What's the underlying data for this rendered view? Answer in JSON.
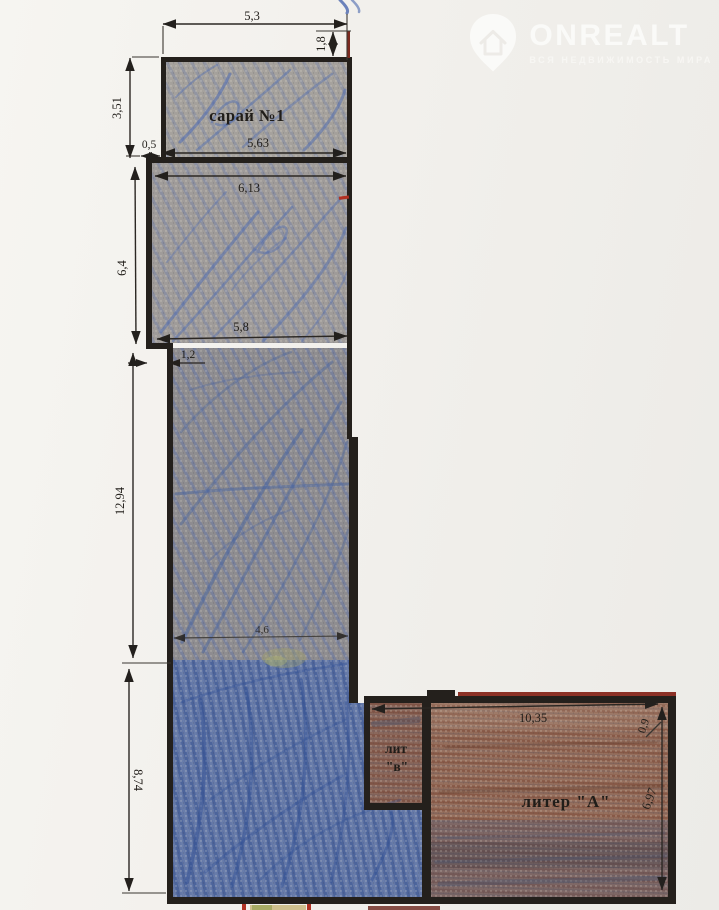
{
  "watermark": {
    "brand": "ONREALT",
    "tagline": "ВСЯ НЕДВИЖИМОСТЬ МИРА"
  },
  "plan": {
    "rooms": {
      "shed_label": "сарай №1",
      "lit_v_line1": "лит",
      "lit_v_line2": "\"в\"",
      "liter_a_label": "литер \"А\""
    },
    "dimensions": {
      "top_width": "5,3",
      "shed_side": "1,8",
      "shed_height": "3,51",
      "left_offset": "0,5",
      "shed_width": "5,63",
      "section2_width": "6,13",
      "section2_height": "6,4",
      "section3_width": "5,8",
      "step": "1,2",
      "section3_height": "12,94",
      "section4_width": "4,6",
      "section4_height": "8,74",
      "liter_a_width": "10,35",
      "liter_a_top": "0,9",
      "liter_a_height": "6,97"
    },
    "colors": {
      "ink": "#24201c",
      "blue_fill": "#6478a8",
      "blue_light": "#a6a29d",
      "brown_fill": "#97705e",
      "red_accent": "#8c3126",
      "paper": "#f2f0ec"
    }
  }
}
